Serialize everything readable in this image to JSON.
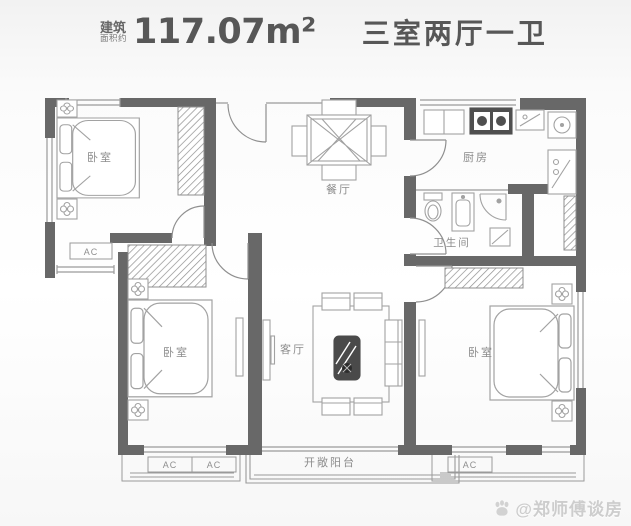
{
  "header": {
    "area_note_top": "建筑",
    "area_note_bottom": "面积约",
    "area_value": "117.07m²",
    "layout_type": "三室两厅一卫"
  },
  "floorplan": {
    "rooms": [
      {
        "id": "bedroom-top-left",
        "label": "卧室"
      },
      {
        "id": "dining-room",
        "label": "餐厅"
      },
      {
        "id": "kitchen",
        "label": "厨房"
      },
      {
        "id": "bathroom",
        "label": "卫生间"
      },
      {
        "id": "bedroom-bottom-left",
        "label": "卧室"
      },
      {
        "id": "living-room",
        "label": "客厅"
      },
      {
        "id": "bedroom-bottom-right",
        "label": "卧室"
      },
      {
        "id": "balcony",
        "label": "开敞阳台"
      }
    ],
    "ac_labels": [
      "AC",
      "AC",
      "AC",
      "AC"
    ],
    "colors": {
      "wall": "#686868",
      "furniture_line": "#9f9f9f",
      "dark_fixture": "#4f4f4f",
      "label_text": "#8c8c8c",
      "watermark": "#cdcdcd"
    }
  },
  "watermark": {
    "text": "@郑师傅谈房"
  }
}
